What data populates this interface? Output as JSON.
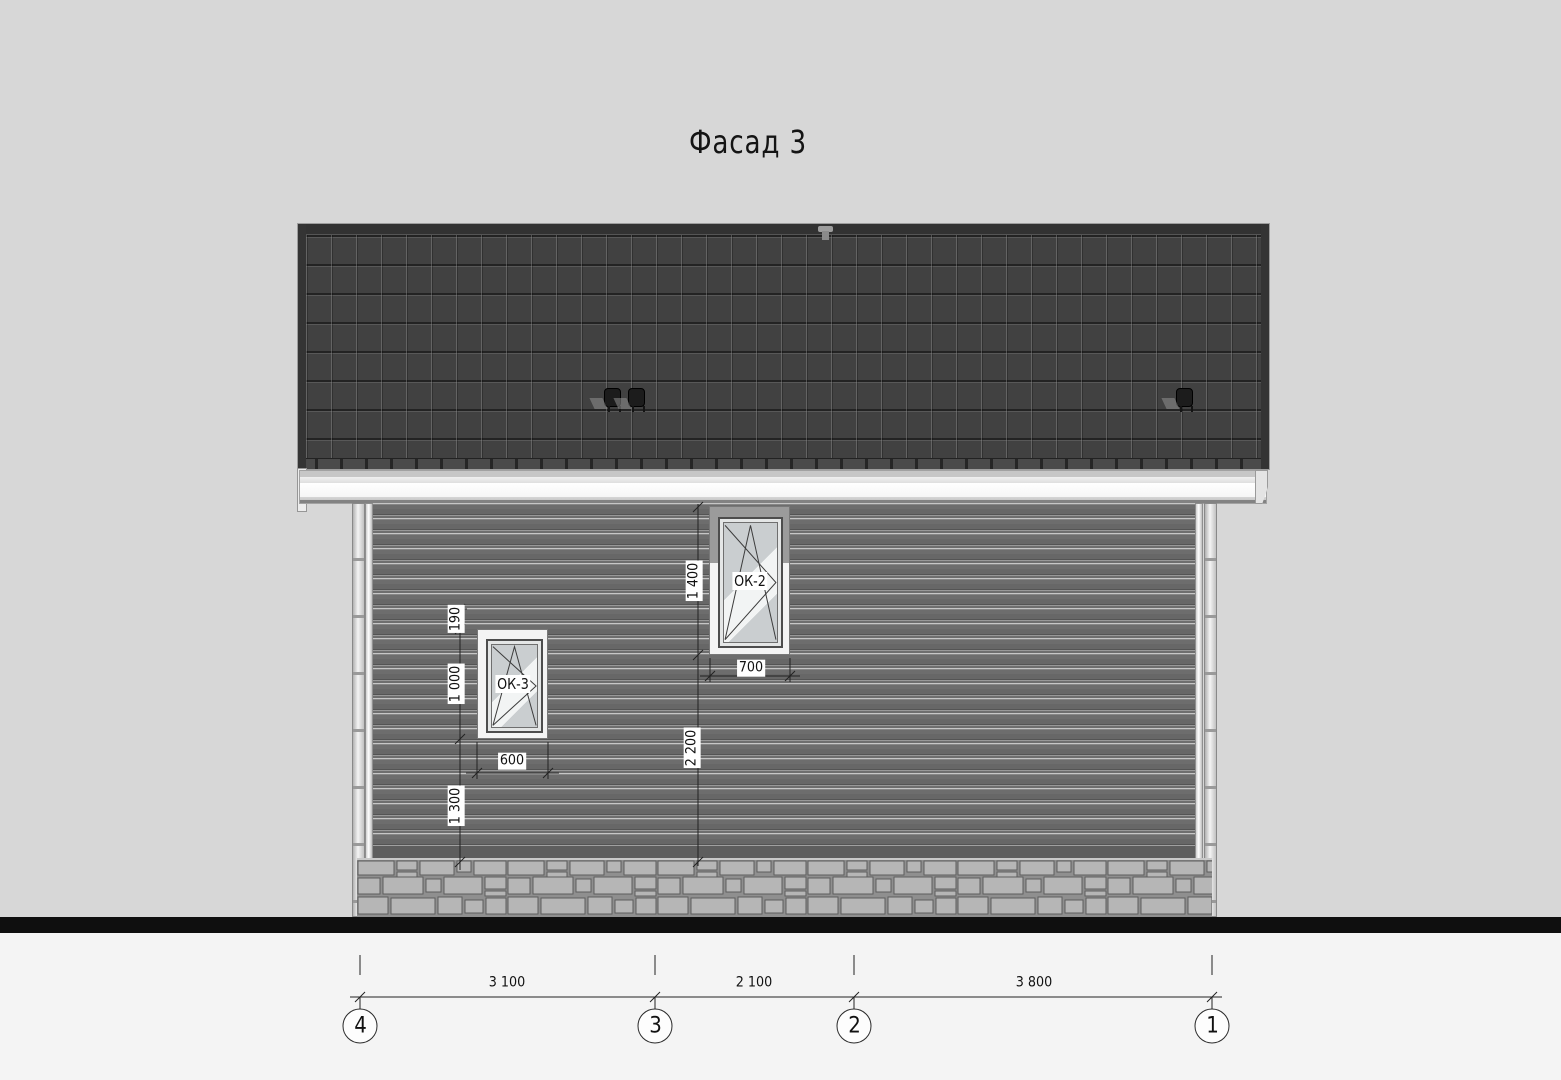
{
  "title": "Фасад 3",
  "windows": {
    "ok2": {
      "label": "ОК-2",
      "height_dim": "1 400",
      "width_dim": "700",
      "below_dim": "2 200"
    },
    "ok3": {
      "label": "ОК-3",
      "above_dim": "190",
      "height_dim": "1 000",
      "below_dim": "1 300",
      "width_dim": "600"
    }
  },
  "bottom_dims": {
    "span_4_3": "3 100",
    "span_3_2": "2 100",
    "span_2_1": "3 800"
  },
  "axes": {
    "a4": "4",
    "a3": "3",
    "a2": "2",
    "a1": "1"
  },
  "colors": {
    "background": "#d7d7d7",
    "roof": "#3f3f3f",
    "wall": "#6e6e6e",
    "foundation_stone": "#b5b5b5",
    "ground": "#0f0f0f",
    "trim": "#f4f4f4"
  }
}
